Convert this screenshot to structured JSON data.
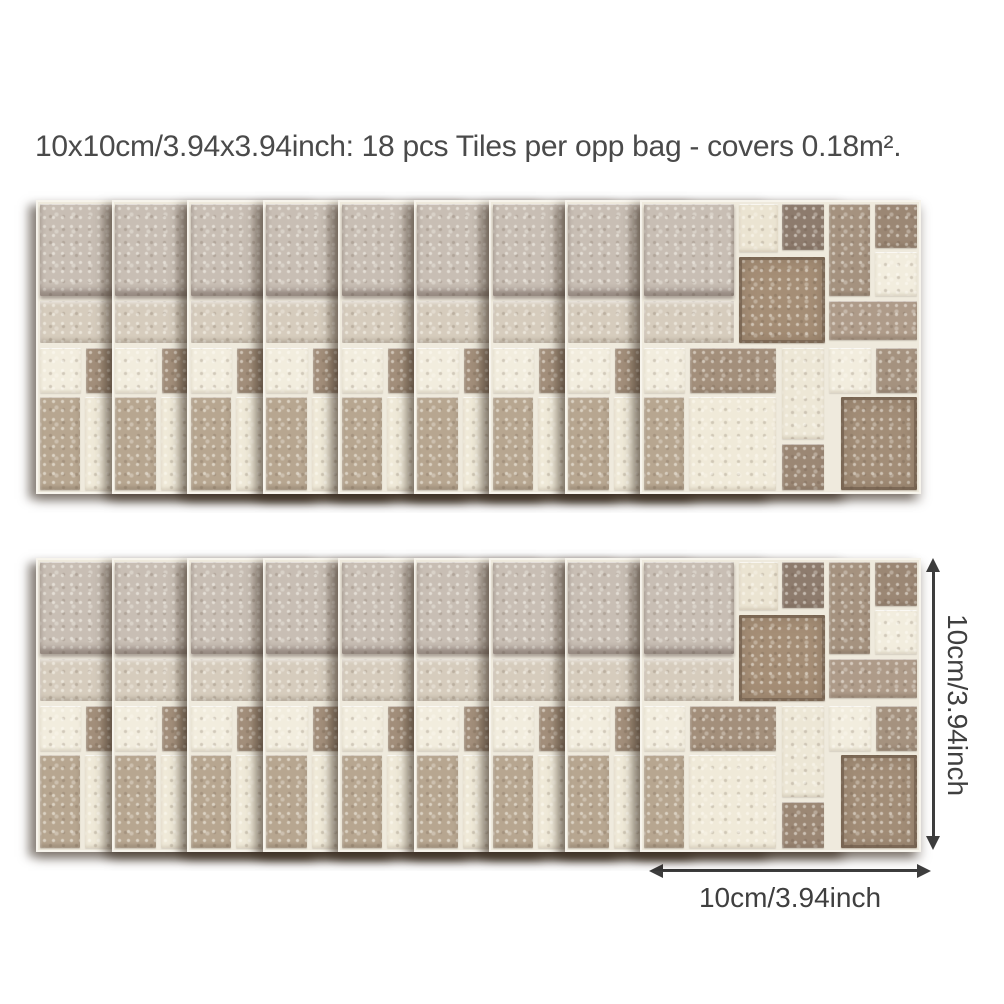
{
  "annotations": {
    "title": "10x10cm/3.94x3.94inch: 18 pcs Tiles per opp bag - covers 0.18m².",
    "vertical_dimension_label": "10cm/3.94inch",
    "horizontal_dimension_label": "10cm/3.94inch",
    "arrow_color": "#3d3d3d",
    "text_color": "#4a4a4a"
  },
  "product": {
    "description": "mosaic tile sticker sheets fanned in two rows",
    "rows": 2,
    "sheets_per_row": 9,
    "pieces_total": 18,
    "palette": {
      "beigeA": "#c8beb4",
      "beigeB": "#d6ccbd",
      "cream": "#ebe4d2",
      "cream2": "#ede7d6",
      "white": "#f2edde",
      "white2": "#f0ead9",
      "brownDark": "#8d7b6d",
      "taupe": "#a5927f",
      "taupe2": "#a38f7b",
      "brownMid": "#9b8774",
      "brownCenter": "#a58e76",
      "brownLight": "#b7a690",
      "brownLight2": "#ae9b89",
      "brownBR": "#a28d77",
      "grout": "#efeadd"
    },
    "mosaic_tiles": [
      {
        "x": 0.7,
        "y": 0.7,
        "w": 32.6,
        "h": 31.8,
        "c": "beigeA"
      },
      {
        "x": 0.7,
        "y": 34.3,
        "w": 32.6,
        "h": 14.2,
        "c": "beigeB"
      },
      {
        "x": 35.1,
        "y": 0.7,
        "w": 13.9,
        "h": 16.4,
        "c": "cream"
      },
      {
        "x": 50.7,
        "y": 0.7,
        "w": 15.0,
        "h": 15.8,
        "c": "brownDark"
      },
      {
        "x": 67.4,
        "y": 0.7,
        "w": 14.9,
        "h": 31.8,
        "c": "taupe"
      },
      {
        "x": 84.0,
        "y": 0.7,
        "w": 15.3,
        "h": 15.0,
        "c": "brownMid"
      },
      {
        "x": 84.0,
        "y": 17.4,
        "w": 15.3,
        "h": 15.1,
        "c": "white"
      },
      {
        "x": 35.1,
        "y": 18.8,
        "w": 30.8,
        "h": 29.7,
        "c": "brownCenter"
      },
      {
        "x": 67.4,
        "y": 34.3,
        "w": 31.9,
        "h": 13.4,
        "c": "brownLight2"
      },
      {
        "x": 0.7,
        "y": 50.3,
        "w": 15.0,
        "h": 15.4,
        "c": "white"
      },
      {
        "x": 17.4,
        "y": 50.3,
        "w": 31.0,
        "h": 15.4,
        "c": "taupe2"
      },
      {
        "x": 50.7,
        "y": 50.3,
        "w": 15.0,
        "h": 31.4,
        "c": "cream2"
      },
      {
        "x": 67.4,
        "y": 50.3,
        "w": 15.3,
        "h": 15.4,
        "c": "white"
      },
      {
        "x": 84.4,
        "y": 50.3,
        "w": 14.9,
        "h": 15.4,
        "c": "taupe"
      },
      {
        "x": 0.7,
        "y": 67.4,
        "w": 14.6,
        "h": 31.9,
        "c": "brownLight"
      },
      {
        "x": 17.0,
        "y": 67.4,
        "w": 31.4,
        "h": 31.9,
        "c": "white2"
      },
      {
        "x": 50.7,
        "y": 83.6,
        "w": 15.0,
        "h": 15.7,
        "c": "brownMid"
      },
      {
        "x": 71.8,
        "y": 67.4,
        "w": 27.5,
        "h": 31.9,
        "c": "brownBR"
      }
    ]
  }
}
